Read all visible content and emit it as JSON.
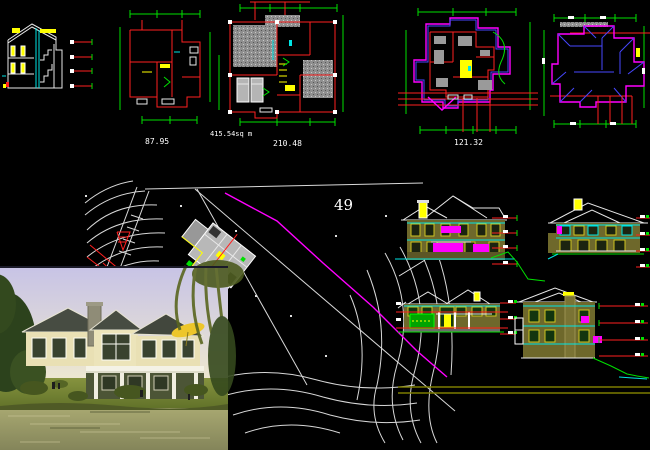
{
  "viewport": {
    "type": "cad-model-space",
    "width": 650,
    "height": 450,
    "background": "#000000"
  },
  "palette": {
    "walls_red": "#ff2020",
    "dimension_green": "#00e000",
    "trim_cyan": "#00e5e5",
    "roof_magenta": "#ff00ff",
    "ridge_blue": "#4747ff",
    "highlight_yellow": "#ffff00",
    "linework_white": "#e8e8e8",
    "hatch_gray": "#8f8f8f",
    "facade_olive": "#6e682b"
  },
  "plans": {
    "upper_floor": {
      "area_label": "87.95"
    },
    "ground_floor": {
      "total_area_label": "415.54sq m",
      "area_label": "210.48"
    },
    "second_floor": {
      "area_label": "121.32"
    }
  },
  "site_plan": {
    "lot_number": "49"
  }
}
